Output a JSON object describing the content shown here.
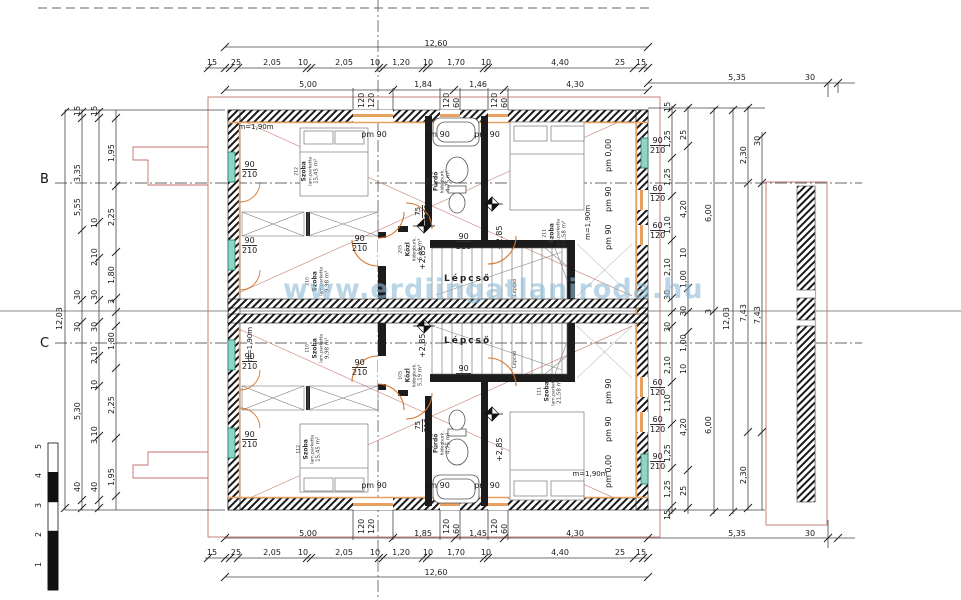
{
  "watermark": "www.erdiingatlaniroda.hu",
  "axis": {
    "b": "B",
    "c": "C"
  },
  "scalebar": [
    "5",
    "4",
    "3",
    "2",
    "1"
  ],
  "stairs_label": "Lépcső",
  "level_mark": "+2,85",
  "openings": {
    "w90": "90",
    "w210": "210",
    "w75": "75",
    "w60": "60",
    "w120": "120",
    "w15": "15",
    "pm90": "pm 90",
    "pm000": "pm 0,00",
    "m190": "m=1,90m"
  },
  "rooms": {
    "r212": {
      "no": "212",
      "name": "Szoba",
      "finish": "lam.parketta",
      "area": "15,45 m²"
    },
    "r210": {
      "no": "210",
      "name": "Szoba",
      "finish": "lam.parketta",
      "area": "9,98 m²"
    },
    "r206": {
      "no": "206",
      "name": "Fürdő",
      "finish": "hidegburk.",
      "area": "4,75 m²"
    },
    "r205": {
      "no": "205",
      "name": "Közl",
      "finish": "hidegburk.",
      "area": "5,19 m²"
    },
    "r211": {
      "no": "211",
      "name": "Szoba",
      "finish": "lam.parketta",
      "area": "21,58 m²"
    },
    "r112": {
      "no": "112",
      "name": "Szoba",
      "finish": "lam.parketta",
      "area": "15,45 m²"
    },
    "r110": {
      "no": "110",
      "name": "Szoba",
      "finish": "lam.parketta",
      "area": "9,98 m²"
    },
    "r106": {
      "no": "106",
      "name": "Fürdő",
      "finish": "hidegburk.",
      "area": "4,75 m²"
    },
    "r105": {
      "no": "105",
      "name": "Közl",
      "finish": "hidegburk.",
      "area": "5,19 m²"
    },
    "r111": {
      "no": "111",
      "name": "Szoba",
      "finish": "lam.parketta",
      "area": "21,58 m²"
    }
  },
  "dims": {
    "total_h": "12,60",
    "total_v": "12,03",
    "top_row2": [
      "15",
      "25",
      "2,05",
      "10",
      "2,05",
      "10",
      "1,20",
      "10",
      "1,70",
      "10",
      "4,40",
      "25",
      "15"
    ],
    "top_row3": [
      "5,00",
      "1,84",
      "1,46",
      "4,30"
    ],
    "bottom_row3": [
      "5,00",
      "1,85",
      "1,45",
      "4,30"
    ],
    "right_ext": [
      "5,35",
      "30"
    ],
    "left_a": [
      "15",
      "3,35",
      "5,55",
      "30",
      "30",
      "5,30",
      "40"
    ],
    "left_b": [
      "15",
      "10",
      "2,10",
      "30",
      "30",
      "2,10",
      "10",
      "3,10",
      "40"
    ],
    "left_c": [
      "1,95",
      "2,25",
      "1,80",
      "3",
      "1,80",
      "2,25",
      "1,95"
    ],
    "right_a": [
      "15",
      "1,25",
      "1,25",
      "1,10",
      "2,10",
      "30",
      "30",
      "2,10",
      "1,10",
      "1,25",
      "1,25",
      "15"
    ],
    "right_b": [
      "25",
      "4,20",
      "10",
      "1,00",
      "30",
      "1,00",
      "10",
      "4,20",
      "25"
    ],
    "right_c": [
      "6,00",
      "3",
      "6,00"
    ],
    "right_d": "12,03",
    "right_e": [
      "2,30",
      "7,43",
      "2,30"
    ],
    "right_f": [
      "30",
      "7,43"
    ]
  }
}
